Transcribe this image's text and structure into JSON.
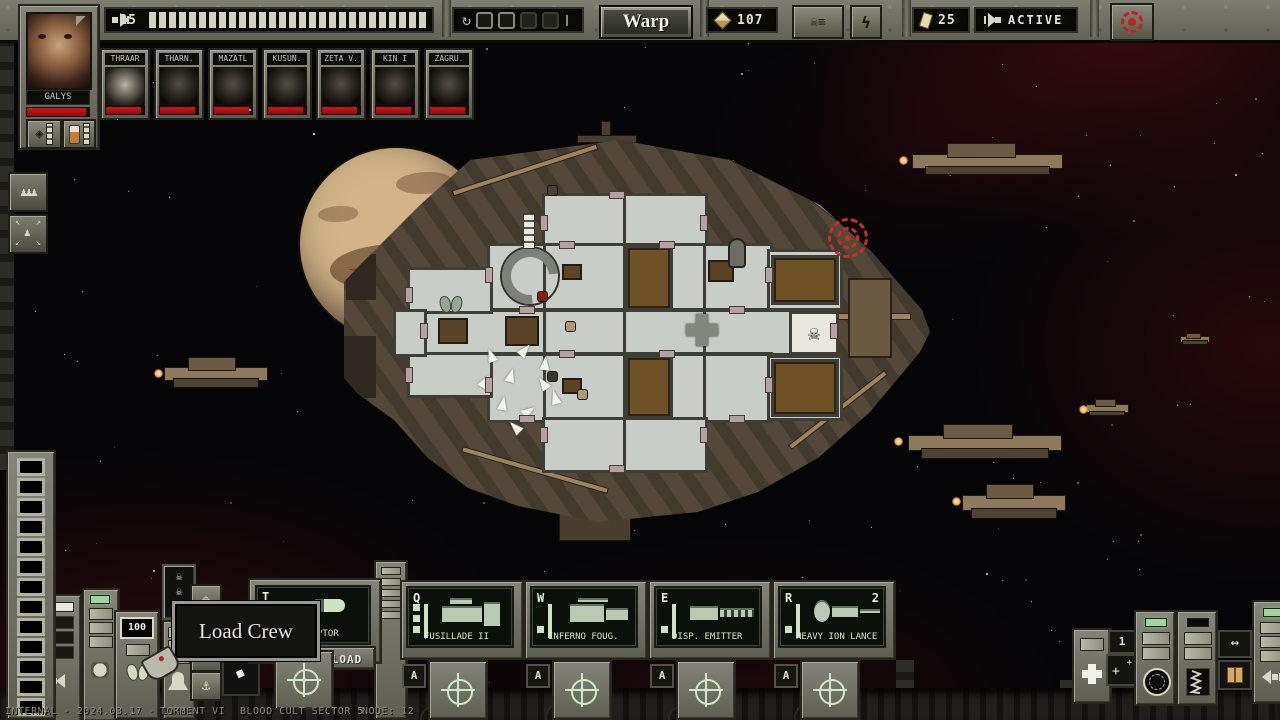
{
  "top_bar": {
    "thrust": {
      "value": "25",
      "segments": 28
    },
    "warp_meter": {
      "pips_total": 4,
      "pips_filled": 2
    },
    "warp_button_label": "Warp",
    "treasury": {
      "value": "107"
    },
    "fuel": {
      "value": "25"
    },
    "drive_status": "ACTIVE"
  },
  "player": {
    "name": "GALYS"
  },
  "crew": {
    "members": [
      {
        "name": "THRAAR"
      },
      {
        "name": "THARN."
      },
      {
        "name": "MAZATL"
      },
      {
        "name": "KUSUN."
      },
      {
        "name": "ZETA V."
      },
      {
        "name": "KIN I"
      },
      {
        "name": "ZAGRU."
      }
    ]
  },
  "tooltip": {
    "text": "Load Crew"
  },
  "ordnance": {
    "key": "T",
    "label_visible": "PTOR",
    "load_button": "LOAD"
  },
  "weapons": [
    {
      "key": "Q",
      "label": "FUSILLADE II",
      "ammo": 3
    },
    {
      "key": "W",
      "label": "INFERNO FOUG.",
      "ammo": 1
    },
    {
      "key": "E",
      "label": "DISP. EMITTER",
      "ammo": 1
    },
    {
      "key": "R",
      "label": "HEAVY ION LANCE",
      "ammo": 1,
      "count": "2"
    }
  ],
  "auto_label": "A",
  "gauges": {
    "oxygen": "100"
  },
  "systems": {
    "medbay_count": "1"
  },
  "status_bar": {
    "left": "INTERNAL - 2024.03.17 - 1940",
    "game": "TORMENT VI",
    "location": "BLOOD CULT SECTOR 5",
    "node": "NODE: 12"
  },
  "icons": {
    "lightning": "ϟ",
    "refresh": "↻",
    "undo": "↶",
    "down_in": "↴",
    "hook": "⚓",
    "move": "⌖",
    "skull": "☠",
    "pawns": "♟♟♟",
    "pawn": "♟",
    "arrows_lr": "↔",
    "diamond_pointer": "◆",
    "gem": "◈",
    "contracts": "☠≡"
  },
  "colors": {
    "health_red": "#c01010",
    "screen_green": "#cfe3c4",
    "accent_red": "#c43022"
  }
}
